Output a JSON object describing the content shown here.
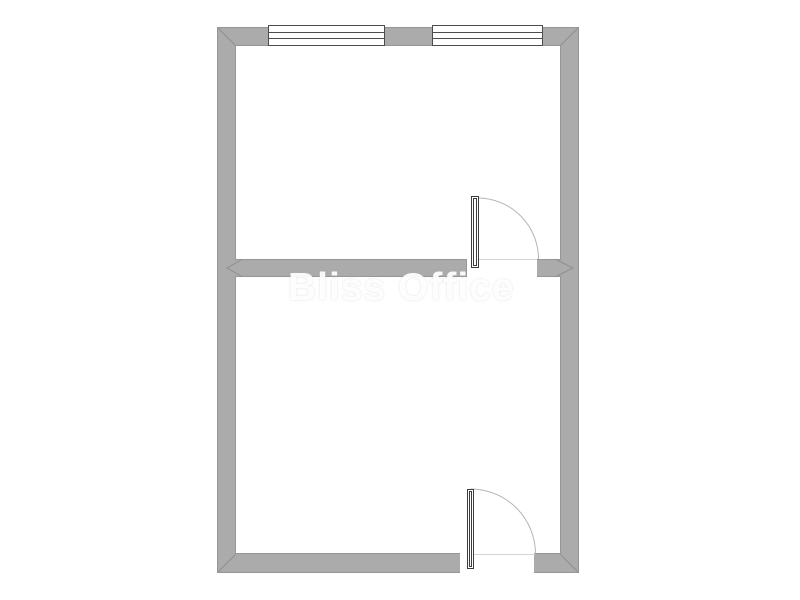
{
  "watermark": {
    "text": "Bliss Office"
  },
  "colors": {
    "background": "#ffffff",
    "floor": "#ffffff",
    "wall_fill": "#ababab",
    "wall_edge": "#969696",
    "seam_line": "#8f8f8f",
    "window_frame": "#4c4c4c",
    "door_frame": "#3c3c3c",
    "door_arc": "#b4b4b4",
    "threshold_line": "#d4d4d4",
    "watermark_color": "rgba(255,255,255,0.92)"
  },
  "plan": {
    "rooms_visible": 2,
    "symbols": {
      "windows": [
        "window-1",
        "window-2"
      ],
      "doors": [
        "door-1",
        "door-2"
      ]
    }
  }
}
